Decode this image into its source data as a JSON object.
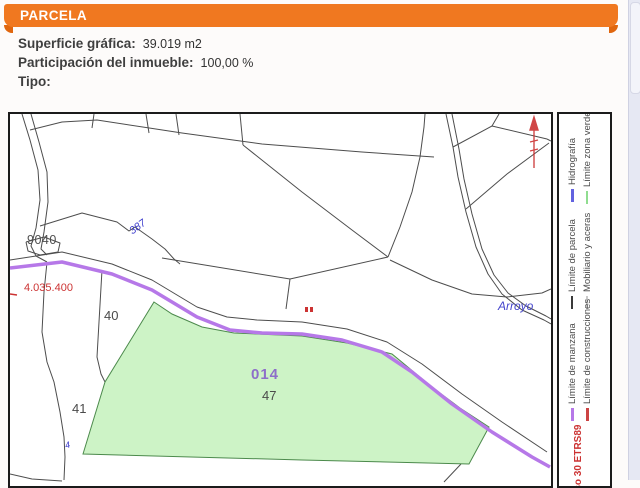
{
  "header": {
    "title": "PARCELA",
    "accent_color": "#f07820"
  },
  "info": {
    "rows": [
      {
        "label": "Superficie gráfica:",
        "value": "39.019 m2"
      },
      {
        "label": "Participación del inmueble:",
        "value": "100,00 %"
      },
      {
        "label": "Tipo:",
        "value": ""
      }
    ]
  },
  "map": {
    "labels": {
      "block_number": "9040",
      "stream_number": "387",
      "grid_northing": "4.035.400",
      "parcel_40": "40",
      "parcel_41": "41",
      "parcel_41_sub": "4",
      "green_parcel_code": "014",
      "green_parcel_number": "47",
      "stream_name": "Arroyo"
    },
    "colors": {
      "green_fill": "#cdf3c6",
      "green_stroke": "#4c8a4c",
      "manzana_line": "#b678e8",
      "parcel_line": "#4d4d4d",
      "hydro_text": "#3b3bcc",
      "red_marks": "#cc3333"
    }
  },
  "legend": {
    "items": [
      {
        "label": "Límite de parcela",
        "color": "#3a3a3a"
      },
      {
        "label": "Límite zona verde",
        "color": "#90dd90"
      },
      {
        "label": "Hidrografía",
        "color": "#6262e0"
      },
      {
        "label": "Mobiliario y aceras",
        "color": "#c9c9c9"
      },
      {
        "label": "Límite de manzana",
        "color": "#b678e8"
      },
      {
        "label": "Límite de construcciones",
        "color": "#cc4444"
      }
    ],
    "projection": "Huso 30 ETRS89"
  }
}
